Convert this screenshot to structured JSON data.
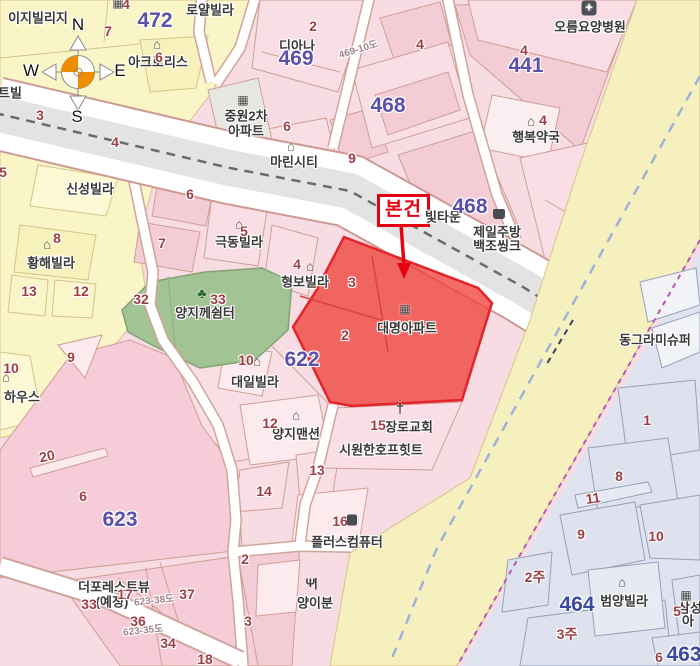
{
  "meta": {
    "title": "지적편집도 (cadastral map view)",
    "width": 700,
    "height": 666
  },
  "colors": {
    "subject_fill": "#f0423c",
    "subject_stroke": "#e3242b",
    "annotation_red": "#e60012",
    "block_number_purple": "#5b51a8",
    "block_number_blue": "#3b4a9f",
    "parcel_number_red": "#9c3f44",
    "park_green": "#a2c394",
    "road_yellow": "#f6efbe",
    "boundary_purple": "#b05ab0",
    "centerline_blue": "#9fb3d9"
  },
  "compass": {
    "n": "N",
    "w": "W",
    "e": "E",
    "s": "S"
  },
  "subject": {
    "label": "본건"
  },
  "icon_glyphs": {
    "house": "⌂",
    "tree": "♣",
    "church": "†",
    "building": "▦",
    "hospital": "+",
    "kettle": "",
    "bag": "",
    "restaurant": "Ψ|"
  },
  "icons": [
    {
      "k": "building",
      "x": 118,
      "y": 3
    },
    {
      "k": "house",
      "x": 157,
      "y": 44
    },
    {
      "k": "building",
      "x": 243,
      "y": 100
    },
    {
      "k": "house",
      "x": 291,
      "y": 146
    },
    {
      "k": "hospital",
      "x": 589,
      "y": 8
    },
    {
      "k": "house",
      "x": 531,
      "y": 121
    },
    {
      "k": "kettle",
      "x": 499,
      "y": 214
    },
    {
      "k": "house",
      "x": 47,
      "y": 244
    },
    {
      "k": "house",
      "x": 239,
      "y": 224
    },
    {
      "k": "house",
      "x": 310,
      "y": 266
    },
    {
      "k": "tree",
      "x": 202,
      "y": 293
    },
    {
      "k": "house",
      "x": 257,
      "y": 361
    },
    {
      "k": "house",
      "x": 296,
      "y": 415
    },
    {
      "k": "church",
      "x": 400,
      "y": 408
    },
    {
      "k": "building",
      "x": 405,
      "y": 309
    },
    {
      "k": "bag",
      "x": 352,
      "y": 520
    },
    {
      "k": "restaurant",
      "x": 311,
      "y": 583
    },
    {
      "k": "house",
      "x": 6,
      "y": 377
    },
    {
      "k": "house",
      "x": 622,
      "y": 582
    },
    {
      "k": "building",
      "x": 686,
      "y": 595
    }
  ],
  "labels": {
    "poi": [
      {
        "t": "이지빌리지",
        "x": 38,
        "y": 17
      },
      {
        "t": "로얄빌라",
        "x": 210,
        "y": 9
      },
      {
        "t": "아크로리스",
        "x": 158,
        "y": 61
      },
      {
        "t": "디아나",
        "x": 297,
        "y": 45
      },
      {
        "t": "중원2차",
        "x": 246,
        "y": 115
      },
      {
        "t": "아파트",
        "x": 246,
        "y": 130
      },
      {
        "t": "마린시티",
        "x": 294,
        "y": 161
      },
      {
        "t": "오름요양병원",
        "x": 590,
        "y": 26
      },
      {
        "t": "행복약국",
        "x": 536,
        "y": 136
      },
      {
        "t": "빛타운",
        "x": 443,
        "y": 216
      },
      {
        "t": "제일주방",
        "x": 497,
        "y": 231
      },
      {
        "t": "백조씽크",
        "x": 497,
        "y": 245
      },
      {
        "t": "신성빌라",
        "x": 90,
        "y": 188
      },
      {
        "t": "황해빌라",
        "x": 51,
        "y": 262
      },
      {
        "t": "극동빌라",
        "x": 239,
        "y": 241
      },
      {
        "t": "형보빌라",
        "x": 305,
        "y": 281
      },
      {
        "t": "양지께쉼터",
        "x": 205,
        "y": 312
      },
      {
        "t": "대일빌라",
        "x": 255,
        "y": 381
      },
      {
        "t": "양지맨션",
        "x": 296,
        "y": 433
      },
      {
        "t": "장로교회",
        "x": 409,
        "y": 426
      },
      {
        "t": "시원한호프힛트",
        "x": 381,
        "y": 449
      },
      {
        "t": "대명아파트",
        "x": 407,
        "y": 327
      },
      {
        "t": "플러스컴퓨터",
        "x": 347,
        "y": 541
      },
      {
        "t": "양이분",
        "x": 315,
        "y": 602
      },
      {
        "t": "더포레스트뷰",
        "x": 114,
        "y": 586
      },
      {
        "t": "(예정)",
        "x": 112,
        "y": 601
      },
      {
        "t": "동그라미슈퍼",
        "x": 655,
        "y": 339
      },
      {
        "t": "범양빌라",
        "x": 624,
        "y": 600
      },
      {
        "t": "삼성",
        "x": 690,
        "y": 607
      },
      {
        "t": "아",
        "x": 688,
        "y": 620
      },
      {
        "t": "하우스",
        "x": 22,
        "y": 396
      },
      {
        "t": "트빌",
        "x": 10,
        "y": 92
      }
    ],
    "parcel_numbers": [
      {
        "t": "4",
        "x": 126,
        "y": 4
      },
      {
        "t": "7",
        "x": 108,
        "y": 31
      },
      {
        "t": "6",
        "x": 159,
        "y": 57
      },
      {
        "t": "2",
        "x": 313,
        "y": 26
      },
      {
        "t": "4",
        "x": 420,
        "y": 44
      },
      {
        "t": "4",
        "x": 524,
        "y": 50
      },
      {
        "t": "4",
        "x": 543,
        "y": 120
      },
      {
        "t": "3",
        "x": 40,
        "y": 115
      },
      {
        "t": "4",
        "x": 115,
        "y": 142
      },
      {
        "t": "5",
        "x": 3,
        "y": 172
      },
      {
        "t": "6",
        "x": 287,
        "y": 126
      },
      {
        "t": "9",
        "x": 352,
        "y": 158
      },
      {
        "t": "6",
        "x": 190,
        "y": 194
      },
      {
        "t": "7",
        "x": 162,
        "y": 243
      },
      {
        "t": "5",
        "x": 244,
        "y": 231
      },
      {
        "t": "4",
        "x": 297,
        "y": 264
      },
      {
        "t": "8",
        "x": 57,
        "y": 238
      },
      {
        "t": "13",
        "x": 29,
        "y": 291
      },
      {
        "t": "12",
        "x": 81,
        "y": 291
      },
      {
        "t": "32",
        "x": 141,
        "y": 299
      },
      {
        "t": "33",
        "x": 218,
        "y": 299
      },
      {
        "t": "3",
        "x": 352,
        "y": 282
      },
      {
        "t": "2",
        "x": 345,
        "y": 335
      },
      {
        "t": "9",
        "x": 71,
        "y": 357
      },
      {
        "t": "10",
        "x": 11,
        "y": 368
      },
      {
        "t": "10",
        "x": 246,
        "y": 360
      },
      {
        "t": "12",
        "x": 270,
        "y": 423
      },
      {
        "t": "15",
        "x": 378,
        "y": 425
      },
      {
        "t": "13",
        "x": 317,
        "y": 470
      },
      {
        "t": "14",
        "x": 264,
        "y": 491
      },
      {
        "t": "16",
        "x": 340,
        "y": 521
      },
      {
        "t": "6",
        "x": 83,
        "y": 496
      },
      {
        "t": "20",
        "x": 47,
        "y": 456,
        "r": -12
      },
      {
        "t": "2",
        "x": 245,
        "y": 559
      },
      {
        "t": "3",
        "x": 248,
        "y": 621
      },
      {
        "t": "17",
        "x": 125,
        "y": 594
      },
      {
        "t": "33",
        "x": 89,
        "y": 604
      },
      {
        "t": "37",
        "x": 187,
        "y": 594
      },
      {
        "t": "36",
        "x": 138,
        "y": 621
      },
      {
        "t": "34",
        "x": 168,
        "y": 643
      },
      {
        "t": "18",
        "x": 205,
        "y": 659
      },
      {
        "t": "1",
        "x": 647,
        "y": 420
      },
      {
        "t": "8",
        "x": 619,
        "y": 476
      },
      {
        "t": "11",
        "x": 593,
        "y": 498,
        "r": -8
      },
      {
        "t": "9",
        "x": 581,
        "y": 534
      },
      {
        "t": "10",
        "x": 656,
        "y": 536
      },
      {
        "t": "2주",
        "x": 535,
        "y": 577
      },
      {
        "t": "3주",
        "x": 567,
        "y": 634
      },
      {
        "t": "5",
        "x": 677,
        "y": 611
      },
      {
        "t": "6",
        "x": 659,
        "y": 657
      }
    ],
    "block_numbers": [
      {
        "t": "472",
        "x": 155,
        "y": 21
      },
      {
        "t": "469",
        "x": 296,
        "y": 59
      },
      {
        "t": "468",
        "x": 388,
        "y": 106
      },
      {
        "t": "441",
        "x": 526,
        "y": 66
      },
      {
        "t": "468",
        "x": 470,
        "y": 207
      },
      {
        "t": "622",
        "x": 302,
        "y": 360
      },
      {
        "t": "623",
        "x": 120,
        "y": 520
      }
    ],
    "block_numbers_blue": [
      {
        "t": "464",
        "x": 577,
        "y": 605
      },
      {
        "t": "463",
        "x": 684,
        "y": 655
      }
    ],
    "road_names": [
      {
        "t": "469-10도",
        "x": 358,
        "y": 48,
        "r": -17
      },
      {
        "t": "623-38도",
        "x": 154,
        "y": 599,
        "r": -6
      },
      {
        "t": "623-35도",
        "x": 143,
        "y": 629,
        "r": -6
      }
    ]
  }
}
